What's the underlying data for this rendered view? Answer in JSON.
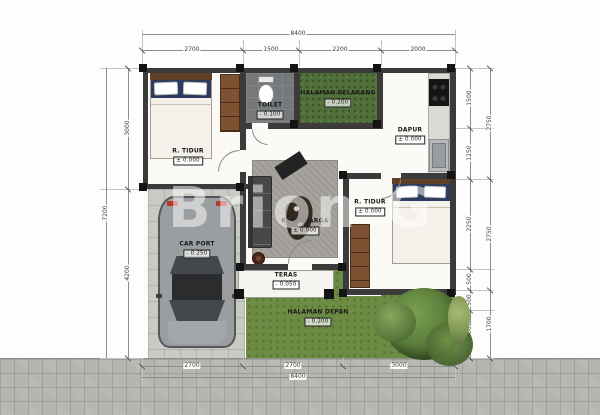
{
  "watermark": {
    "text": "Brion G"
  },
  "rooms": {
    "bedroom1": {
      "name": "R. TIDUR",
      "elevation": "± 0.000"
    },
    "toilet": {
      "name": "TOILET",
      "elevation": "- 0.100"
    },
    "backyard": {
      "name": "HALAMAN BELAKANG",
      "elevation": "- 0.200"
    },
    "kitchen": {
      "name": "DAPUR",
      "elevation": "± 0.000"
    },
    "family": {
      "name": "R. KELUARGA",
      "elevation": "± 0.000"
    },
    "bedroom2": {
      "name": "R. TIDUR",
      "elevation": "± 0.000"
    },
    "carport": {
      "name": "CAR PORT",
      "elevation": "- 0.250"
    },
    "terrace": {
      "name": "TERAS",
      "elevation": "- 0.050"
    },
    "frontyard": {
      "name": "HALAMAN DEPAN",
      "elevation": "- 0.200"
    }
  },
  "dimensions": {
    "top": {
      "total": "8400",
      "segments": [
        "2700",
        "1500",
        "2200",
        "2000"
      ]
    },
    "bottom": {
      "total": "8400",
      "segments": [
        "2700",
        "2700",
        "3000"
      ]
    },
    "left": {
      "total": "7200",
      "segments": [
        "3000",
        "4200"
      ]
    },
    "right": {
      "outer": [
        "2750",
        "2750",
        "1700"
      ],
      "inner": [
        "1500",
        "1250",
        "2250",
        "500",
        "500",
        "1200"
      ]
    }
  },
  "colors": {
    "wall": "#3b3b3b",
    "grass": "#6d8c43",
    "grass_dark": "#52713a",
    "paving": "#c9cac4",
    "road": "#b4b6b0",
    "bedding_navy": "#2c3b5e",
    "wood": "#7c5233",
    "rug": "#a6a49d",
    "accent_red": "#b3352c"
  }
}
